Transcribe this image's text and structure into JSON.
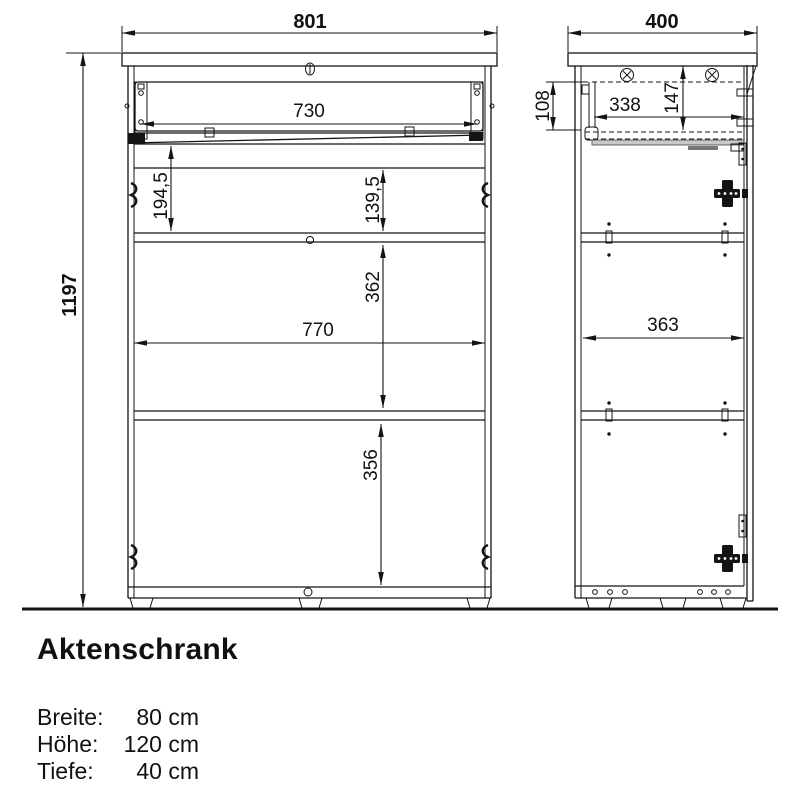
{
  "drawing": {
    "front_view": {
      "overall_width": "801",
      "overall_height": "1197",
      "drawer_inner_width": "730",
      "drawer_section_height": "194,5",
      "top_compartment_height": "139,5",
      "middle_compartment_height": "362",
      "interior_width": "770",
      "bottom_compartment_height": "356"
    },
    "side_view": {
      "overall_depth": "400",
      "drawer_front_height": "108",
      "drawer_inner_depth": "338",
      "drawer_compartment_height": "147",
      "interior_depth": "363"
    }
  },
  "product": {
    "title": "Aktenschrank",
    "specs": [
      {
        "label": "Breite:",
        "value": "80 cm"
      },
      {
        "label": "Höhe:",
        "value": "120 cm"
      },
      {
        "label": "Tiefe:",
        "value": "40 cm"
      }
    ]
  },
  "colors": {
    "line": "#141414",
    "background": "#ffffff",
    "rail_fill": "#c8c8c8"
  }
}
